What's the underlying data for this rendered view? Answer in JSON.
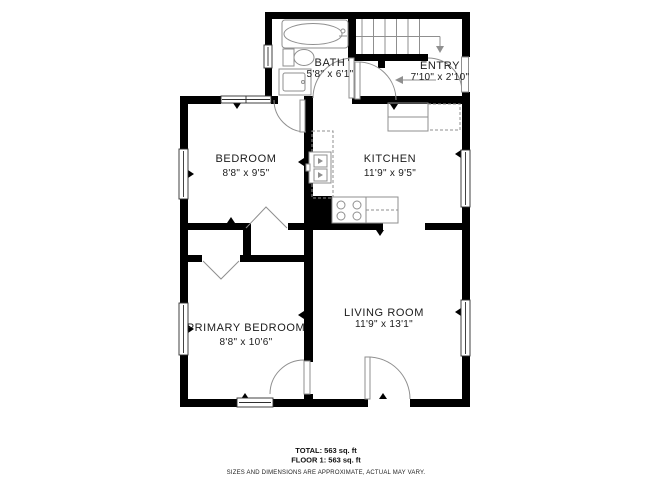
{
  "floorplan": {
    "rooms": {
      "bath": {
        "label": "BATH",
        "dims": "5'8\" x 6'1\""
      },
      "entry": {
        "label": "ENTRY",
        "dims": "7'10\" x 2'10\""
      },
      "bedroom": {
        "label": "BEDROOM",
        "dims": "8'8\" x 9'5\""
      },
      "kitchen": {
        "label": "KITCHEN",
        "dims": "11'9\" x 9'5\""
      },
      "primary_bedroom": {
        "label": "PRIMARY BEDROOM",
        "dims": "8'8\" x 10'6\""
      },
      "living_room": {
        "label": "LIVING ROOM",
        "dims": "11'9\" x 13'1\""
      }
    },
    "colors": {
      "wall": "#000000",
      "fixture": "#8f8f8f",
      "background": "#ffffff"
    }
  },
  "footer": {
    "total": "TOTAL: 563 sq. ft",
    "floor": "FLOOR 1: 563 sq. ft",
    "disclaimer": "SIZES AND DIMENSIONS ARE APPROXIMATE, ACTUAL MAY VARY."
  }
}
